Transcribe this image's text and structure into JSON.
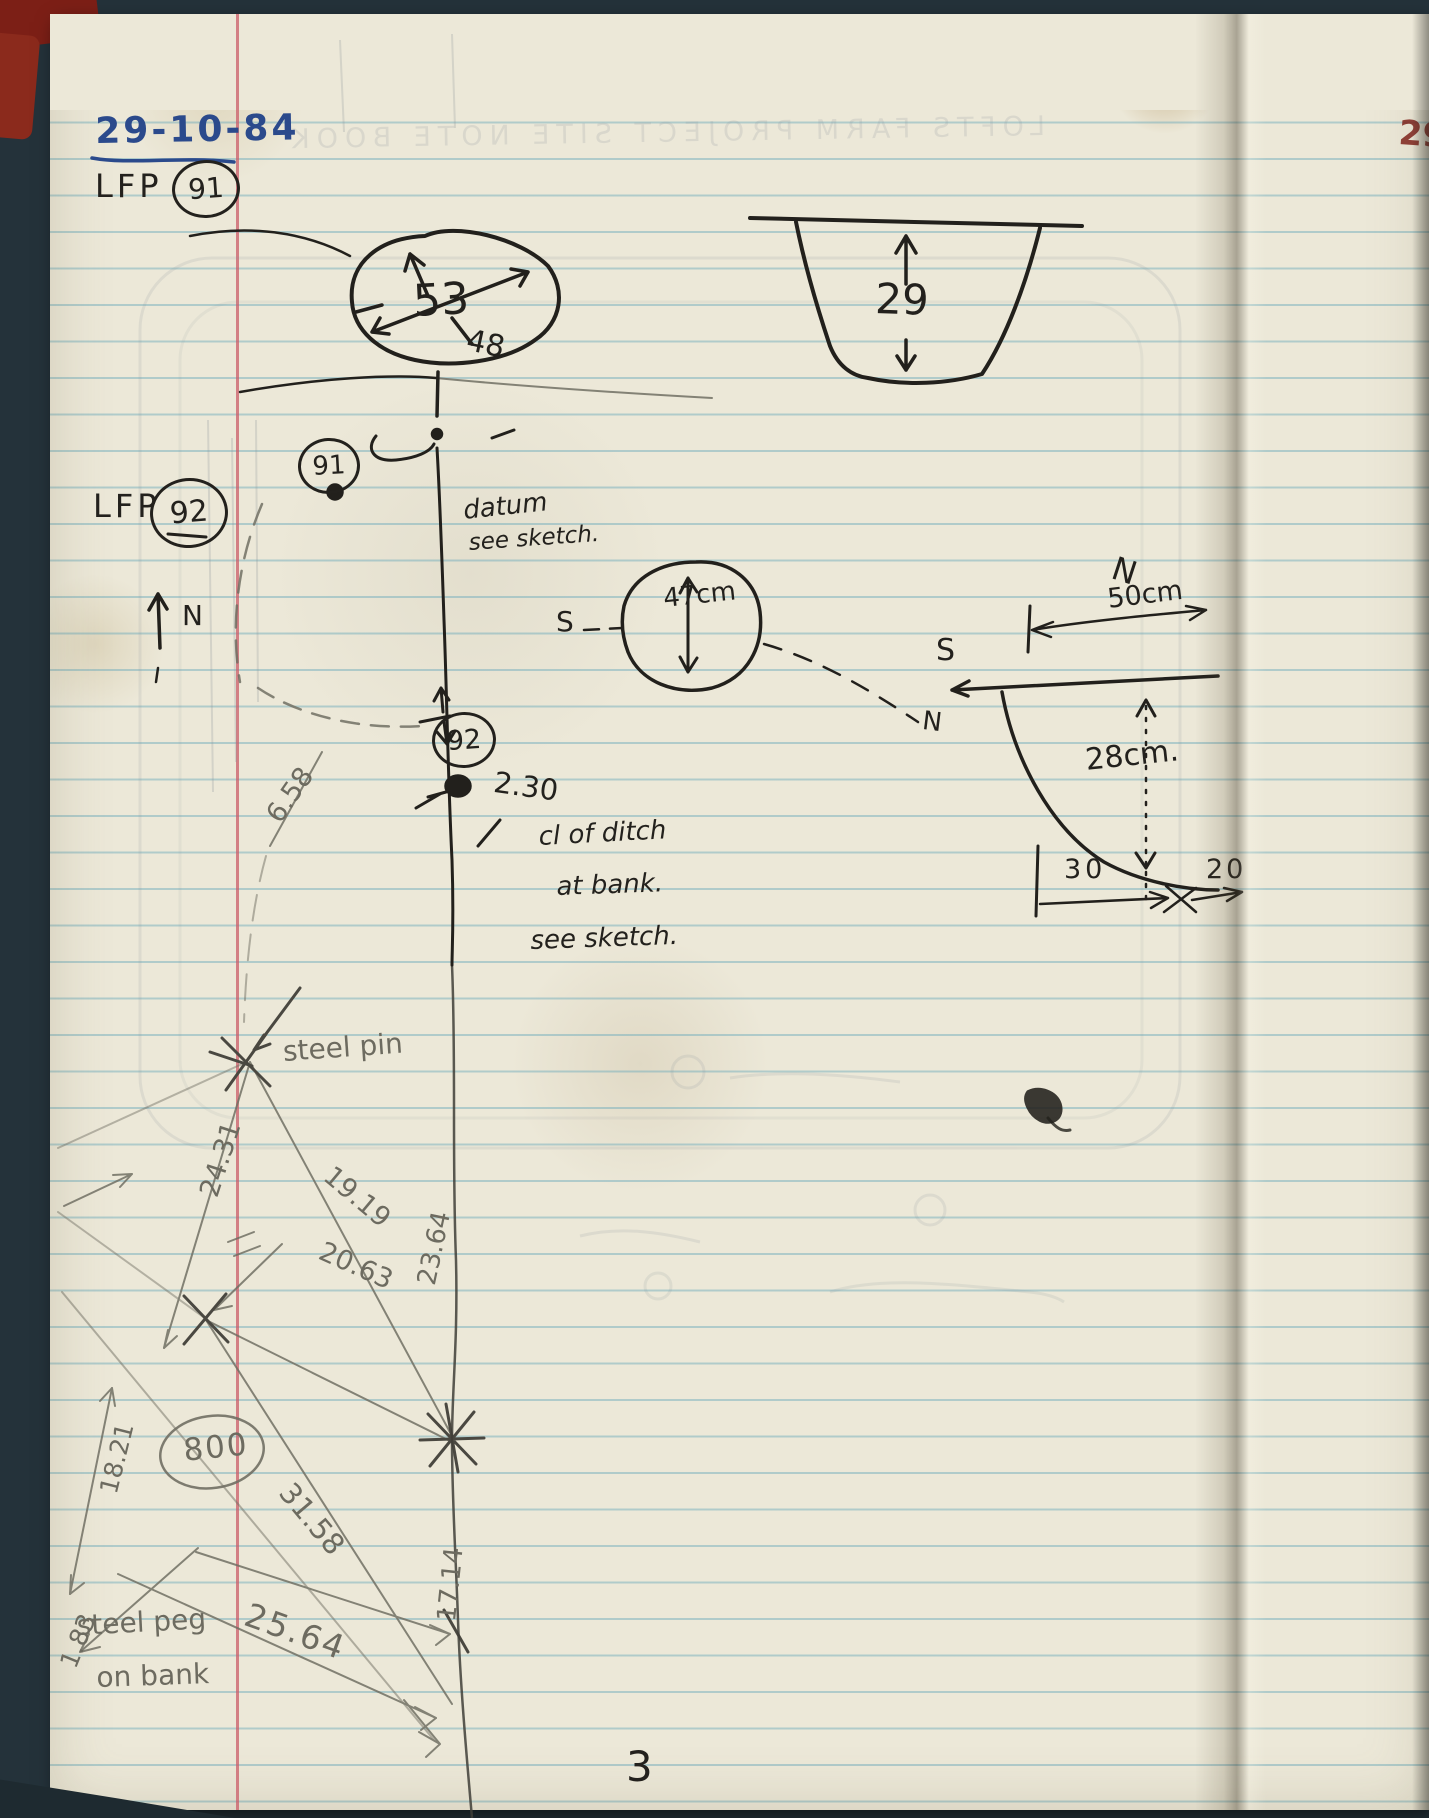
{
  "page": {
    "date": "29-10-84",
    "page_number": "3",
    "ghost_header": "LOFTS FARM PROJECT   SITE NOTE BOOK",
    "corner_mark": "29"
  },
  "entries": {
    "lfp91_prefix": "LFP",
    "lfp91_number": "91",
    "feature91_badge": "91",
    "lfp92_prefix": "LFP",
    "lfp92_number": "92",
    "feature92_badge": "92"
  },
  "plan": {
    "oval_dim_main": "53",
    "oval_dim_secondary": "48",
    "north_label": "N",
    "datum_note_line1": "datum",
    "datum_note_line2": "see sketch.",
    "offset_value": "2.30",
    "ditch_note_line1": "cl of ditch",
    "ditch_note_line2": "at bank.",
    "ditch_note_line3": "see sketch."
  },
  "profiles": {
    "ditch_depth": "29",
    "pit_depth": "47cm",
    "pit_south": "S",
    "pit_north": "N",
    "section_south": "S",
    "section_north": "N",
    "section_width": "50cm",
    "section_depth": "28cm.",
    "section_dim_left": "30",
    "section_dim_right": "20"
  },
  "survey": {
    "steel_pin_label": "steel pin",
    "steel_peg_line1": "steel peg",
    "steel_peg_line2": "on bank",
    "station_number": "800",
    "measurements": {
      "m658": "6.58",
      "m2431": "24.31",
      "m1919": "19.19",
      "m2063": "20.63",
      "m1821": "18.21",
      "m2364": "23.64",
      "m3158": "31.58",
      "m1714": "17.14",
      "m183": "1.83",
      "m2564": "25.64"
    }
  },
  "colors": {
    "ink": "#23211d",
    "blue_ink": "#2b4a8c",
    "pencil": "#6d6b60",
    "paper": "#ece8d8",
    "rule_line": "#74aebc",
    "margin_line": "#cb5c68",
    "cover_maroon": "#7c1f16"
  }
}
